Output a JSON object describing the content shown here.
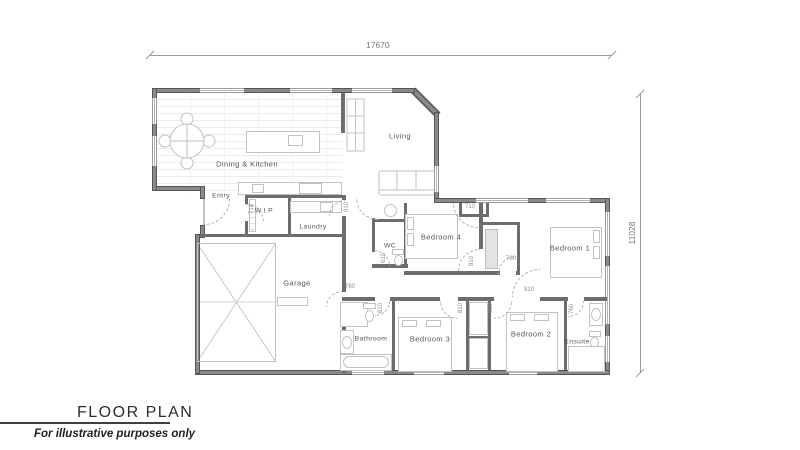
{
  "title_block": {
    "title": "FLOOR PLAN",
    "subtitle": "For illustrative purposes only"
  },
  "plan_dims": {
    "width": "17670",
    "height": "11028"
  },
  "rooms": {
    "dining_kitchen": "Dining & Kitchen",
    "living": "Living",
    "entry": "Entry",
    "wip": "W.I.P",
    "laundry": "Laundry",
    "wc": "WC",
    "bedroom4": "Bedroom 4",
    "bedroom1": "Bedroom 1",
    "garage": "Garage",
    "bathroom": "Bathroom",
    "bedroom3": "Bedroom 3",
    "bedroom2": "Bedroom 2",
    "ensuite": "Ensuite"
  },
  "door_dims": {
    "hall_linen": "710",
    "laundry": "810",
    "wip": "710",
    "garage": "760",
    "bedroom4": "810",
    "wardrobe": "760",
    "bedroom1": "810",
    "wc": "610",
    "bathroom": "610",
    "bedroom3": "810",
    "bedroom2": "810",
    "ensuite": "760"
  },
  "colors": {
    "wall": "#8a8a8a",
    "wall_edge": "#565656",
    "furniture_line": "#c2c2c2",
    "dim_line": "#9a9a9a",
    "label": "#545454"
  }
}
